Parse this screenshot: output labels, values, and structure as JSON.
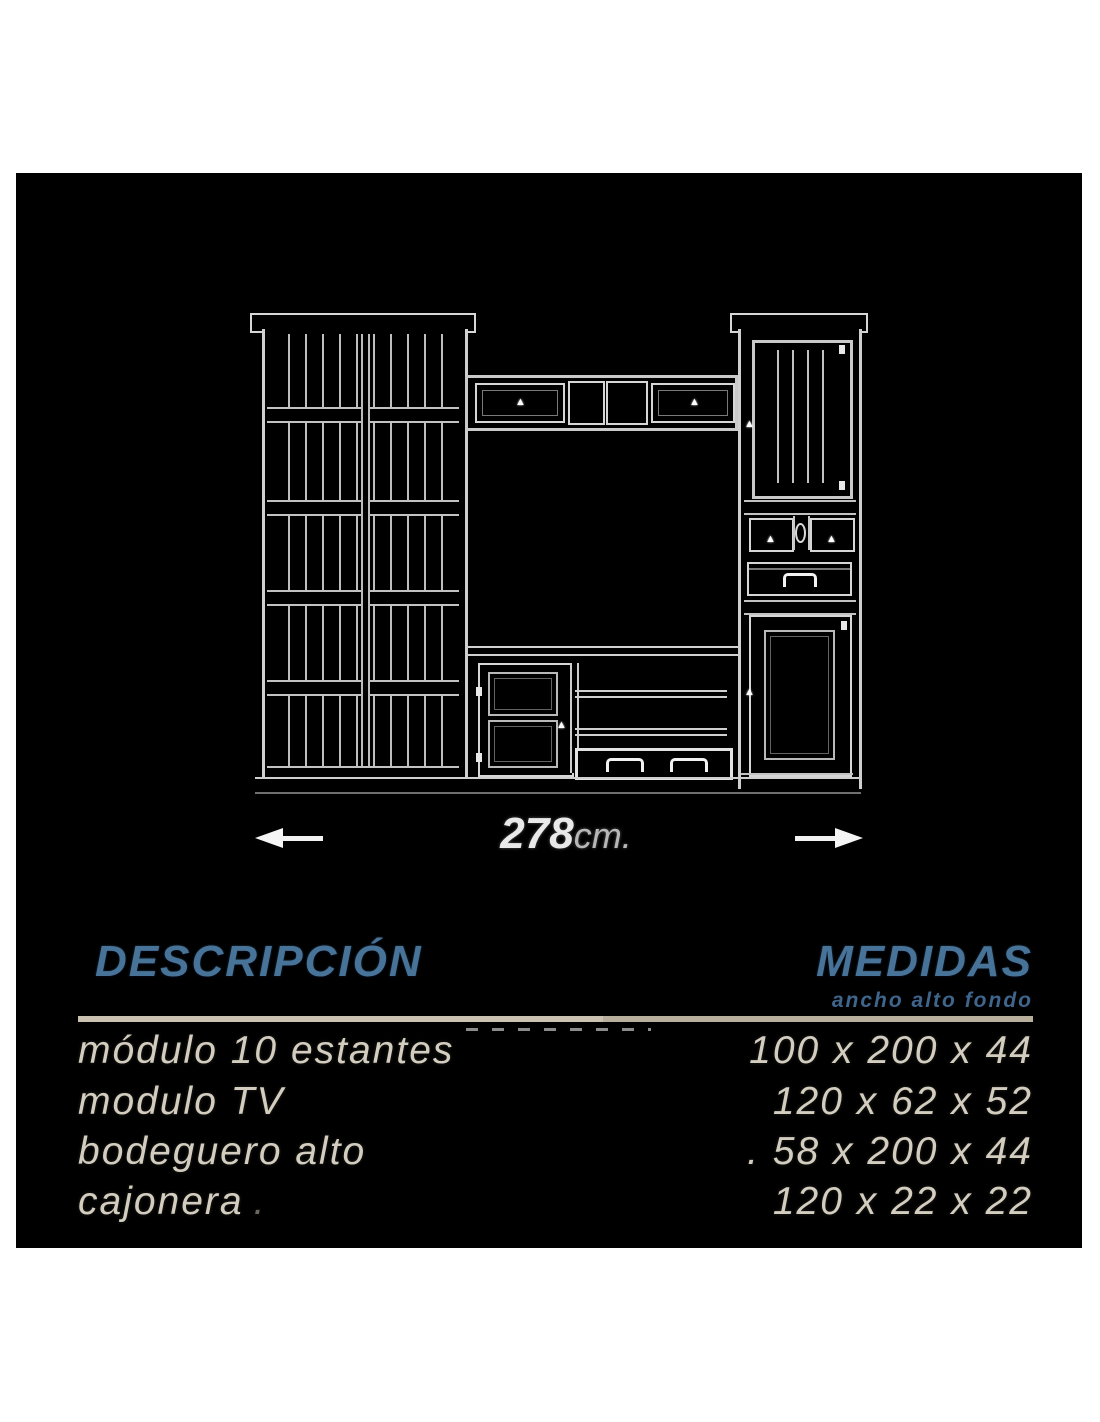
{
  "drawing": {
    "dimension_value": "278",
    "dimension_unit": "cm."
  },
  "icons": {
    "knob": "▲"
  },
  "table": {
    "header": {
      "description": "DESCRIPCIÓN",
      "measures": "MEDIDAS",
      "measures_sub": "ancho alto fondo"
    },
    "rows": [
      {
        "label": "módulo 10 estantes",
        "dims": "100 x 200 x 44"
      },
      {
        "label": "modulo TV",
        "dims": "120 x 62 x 52"
      },
      {
        "label": "bodeguero alto",
        "dims": ". 58 x 200 x 44"
      },
      {
        "label": "cajonera",
        "suffix": ".",
        "dims": "120 x 22 x 22"
      }
    ]
  },
  "colors": {
    "canvas_bg": "#000000",
    "page_bg": "#ffffff",
    "line_white": "#d6d6d6",
    "header_blue": "#477399",
    "rule_beige": "#cac1b0",
    "row_text": "#d3cdbf"
  }
}
